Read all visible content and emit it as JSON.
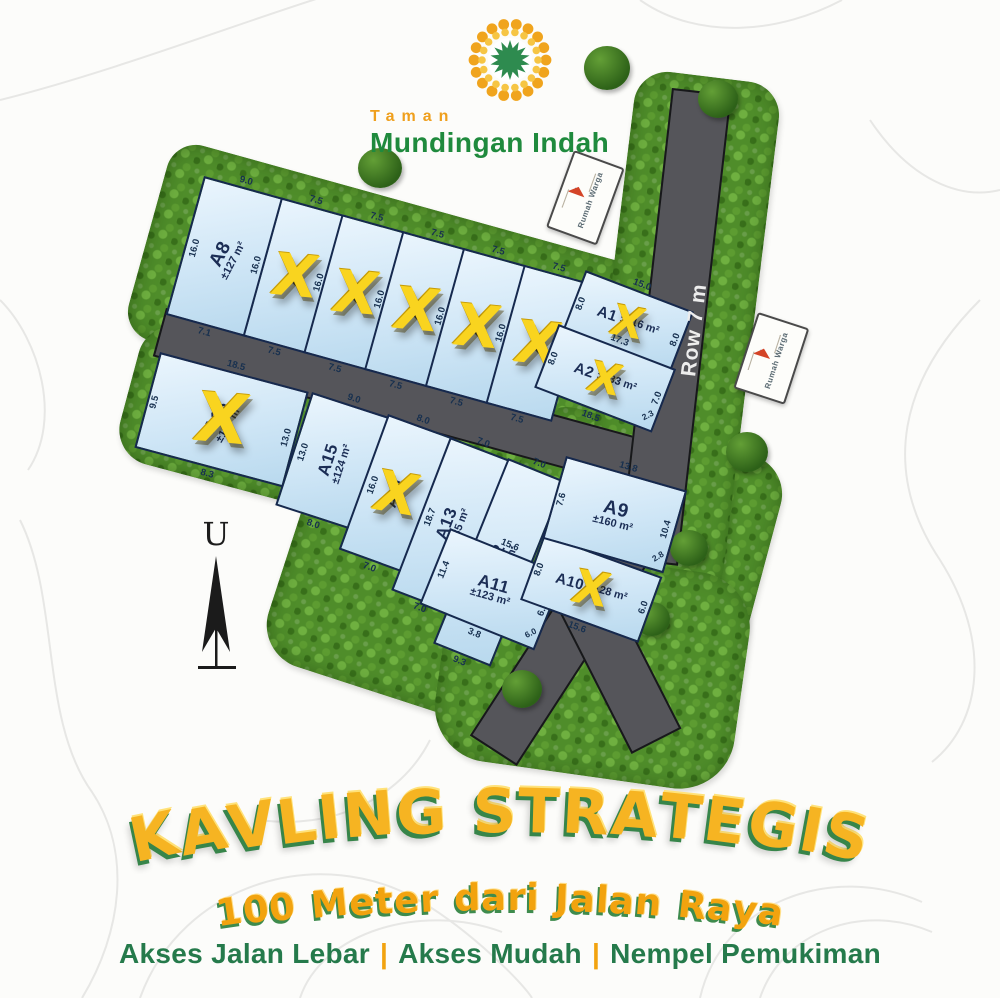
{
  "brand": {
    "top": "Taman",
    "name": "Mundingan Indah"
  },
  "map": {
    "road_label": "Row 7 m",
    "compass_label": "U",
    "sign_label": "Rumah Warga",
    "sold_marker": "X",
    "plots": [
      {
        "id": "A8",
        "area": "±127 m²",
        "sold": false,
        "dims": {
          "top": "9.0",
          "left": "16.0",
          "right": "16.0",
          "bottom": "7.1"
        }
      },
      {
        "id": "A7",
        "area": "",
        "sold": true,
        "dims": {
          "top": "7.5",
          "right": "16.0",
          "bottom": "7.5"
        }
      },
      {
        "id": "A6",
        "area": "",
        "sold": true,
        "dims": {
          "top": "7.5",
          "right": "16.0",
          "bottom": "7.5"
        }
      },
      {
        "id": "A5",
        "area": "",
        "sold": true,
        "dims": {
          "top": "7.5",
          "right": "16.0",
          "bottom": "7.5"
        }
      },
      {
        "id": "A4",
        "area": "",
        "sold": true,
        "dims": {
          "top": "7.5",
          "right": "16.0",
          "bottom": "7.5"
        }
      },
      {
        "id": "A3",
        "area": "",
        "sold": true,
        "dims": {
          "top": "7.5",
          "right": "16.0",
          "bottom": "7.5"
        }
      },
      {
        "id": "A1",
        "area": "±116 m²",
        "sold": true,
        "dims": {
          "top": "15.0",
          "left": "8.0",
          "right": "8.0"
        }
      },
      {
        "id": "A2",
        "area": "±133 m²",
        "sold": true,
        "dims": {
          "top": "17.3",
          "left": "8.0",
          "bottom": "18.5",
          "right": "7.0",
          "corner": "2.3"
        }
      },
      {
        "id": "A16",
        "area": "±127 m²",
        "sold": true,
        "dims": {
          "top": "18.5",
          "left": "9.5",
          "right": "13.0",
          "bottom": "8.3"
        }
      },
      {
        "id": "A15",
        "area": "±124 m²",
        "sold": false,
        "dims": {
          "top": "9.0",
          "left": "13.0",
          "bottom": "8.0"
        }
      },
      {
        "id": "A14",
        "area": "",
        "sold": true,
        "dims": {
          "top": "8.0",
          "left": "16.0",
          "bottom": "7.0"
        }
      },
      {
        "id": "A13",
        "area": "±135 m²",
        "sold": false,
        "dims": {
          "top": "7.0",
          "left": "18.7",
          "bottom": "7.0"
        }
      },
      {
        "id": "A12",
        "area": "±156 m²",
        "sold": false,
        "dims": {
          "top": "7.0",
          "left": "21.4",
          "right": "24.8",
          "bottom": "9.3"
        }
      },
      {
        "id": "A11",
        "area": "±123 m²",
        "sold": false,
        "dims": {
          "top": "15.6",
          "left": "11.4",
          "right": "6.2",
          "bottom": "3.8",
          "corner": "6.0"
        }
      },
      {
        "id": "A10",
        "area": "±128 m²",
        "sold": true,
        "dims": {
          "top": "16.4",
          "left": "8.0",
          "right": "6.0",
          "bottom": "15.6"
        }
      },
      {
        "id": "A9",
        "area": "±160 m²",
        "sold": false,
        "dims": {
          "top": "13.8",
          "left": "7.6",
          "right": "10.4",
          "corner": "2.8"
        }
      }
    ]
  },
  "footer": {
    "title": "KAVLING STRATEGIS",
    "subtitle": "100 Meter dari Jalan Raya",
    "tagline": [
      "Akses Jalan Lebar",
      "Akses Mudah",
      "Nempel Pemukiman"
    ],
    "separator": "|"
  },
  "colors": {
    "plot_fill": "#cfe6f6",
    "plot_border": "#16294e",
    "road": "#55555a",
    "grass": "#4f8d2a",
    "sold_x": "#f9d41f",
    "accent_orange": "#f0a41d",
    "accent_green": "#2c8a3e"
  }
}
